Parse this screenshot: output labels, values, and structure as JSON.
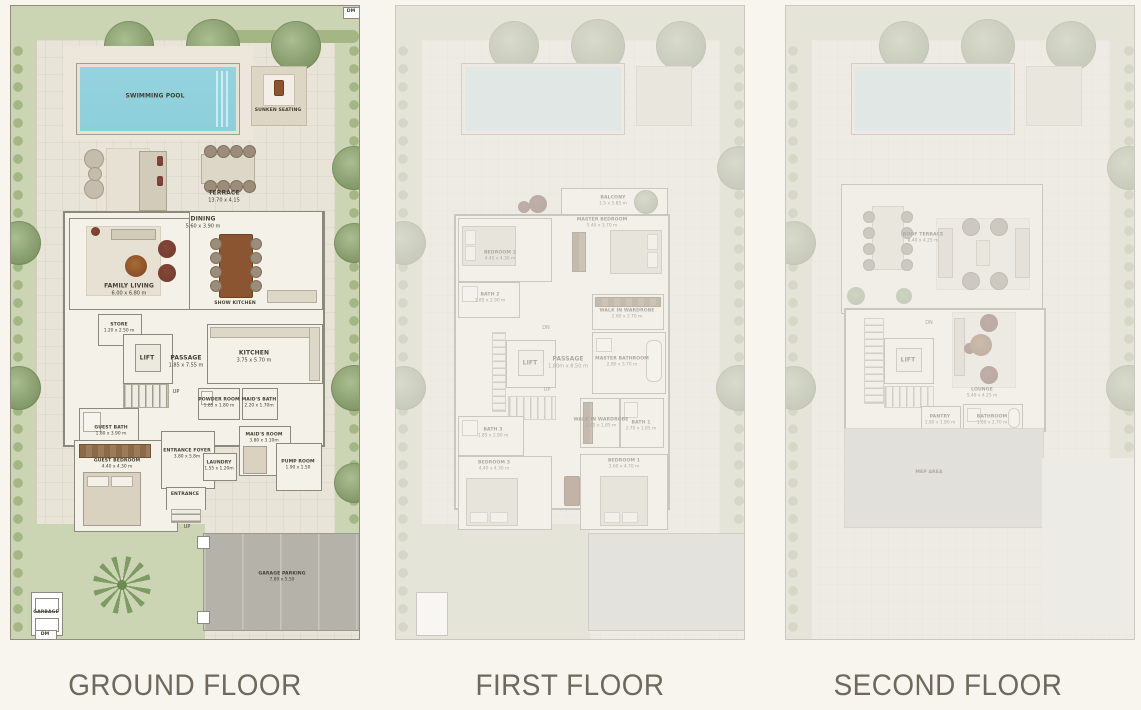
{
  "titles": {
    "ground": "GROUND FLOOR",
    "first": "FIRST FLOOR",
    "second": "SECOND FLOOR"
  },
  "palette": {
    "bg": "#f8f5ee",
    "paving": "#e9e4d8",
    "garden": "#cbd5b4",
    "hedge": "#a3b683",
    "tree": "#8ba171",
    "pool": "#8ccfdb",
    "wall": "#8b887e",
    "floor": "#f4f1e8",
    "wood": "#8a5530",
    "maroon": "#6f3a2d",
    "garage": "#b5b2aa",
    "label": "#454035",
    "title": "#6e685d"
  },
  "ground": {
    "pool": {
      "name": "SWIMMING POOL"
    },
    "sunken": {
      "name": "SUNKEN SEATING"
    },
    "terrace": {
      "name": "TERRACE",
      "dims": "13.70 x 4.15"
    },
    "dining": {
      "name": "DINING",
      "dims": "5.60 x 3.90 m"
    },
    "family_living": {
      "name": "FAMILY LIVING",
      "dims": "6.00 x 6.80 m"
    },
    "show_kitchen": {
      "name": "SHOW KITCHEN"
    },
    "store": {
      "name": "STORE",
      "dims": "1.20 x 2.50 m"
    },
    "lift": "LIFT",
    "passage": {
      "name": "PASSAGE",
      "dims": "1.85 x 7.55 m"
    },
    "kitchen": {
      "name": "KITCHEN",
      "dims": "3.75 x 5.70 m"
    },
    "up_stairs": "UP",
    "powder": {
      "name": "POWDER ROOM",
      "dims": "1.85 x 1.80 m"
    },
    "maids_bath": {
      "name": "MAID'S BATH",
      "dims": "2.20 x 1.70m"
    },
    "guest_bath": {
      "name": "GUEST BATH",
      "dims": "1.80 x 3.90 m"
    },
    "maids_room": {
      "name": "MAID'S ROOM",
      "dims": "3.80 x 3.10m"
    },
    "guest_bedroom": {
      "name": "GUEST BEDROOM",
      "dims": "4.40 x 4.30 m"
    },
    "entrance_foyer": {
      "name": "ENTRANCE FOYER",
      "dims": "3.80 x 5.8m"
    },
    "laundry": {
      "name": "LAUNDRY",
      "dims": "1.55 x 1.20m"
    },
    "pump_room": {
      "name": "PUMP ROOM",
      "dims": "1.90 x 1.50"
    },
    "entrance": "ENTRANCE",
    "up_entrance": "UP",
    "garage": {
      "name": "GARAGE PARKING",
      "dims": "7.80 x 5.50"
    },
    "garbage": "GARBAGE",
    "dm_top": "DM",
    "dm_bottom": "DM"
  },
  "first": {
    "balcony": {
      "name": "BALCONY",
      "dims": "1.5 x 5.85 m"
    },
    "master_bedroom": {
      "name": "MASTER BEDROOM",
      "dims": "5.40 x 3.70 m"
    },
    "bedroom2": {
      "name": "BEDROOM 2",
      "dims": "4.40 x 4.30 m"
    },
    "bath2": {
      "name": "BATH 2",
      "dims": "1.85 x 2.90 m"
    },
    "wiw1": {
      "name": "WALK IN WARDROBE",
      "dims": "2.60 x 3.70 m"
    },
    "dn": "DN",
    "lift": "LIFT",
    "passage": {
      "name": "PASSAGE",
      "dims": "1.80m x 8.50 m"
    },
    "master_bathroom": {
      "name": "MASTER BATHROOM",
      "dims": "2.80 x 3.70 m"
    },
    "up": "UP",
    "bath3": {
      "name": "BATH 3",
      "dims": "1.85 x 2.90 m"
    },
    "wiw2": {
      "name": "WALK IN WARDROBE",
      "dims": "3.05 x 1.85 m"
    },
    "bath1": {
      "name": "BATH 1",
      "dims": "2.70 x 1.85 m"
    },
    "bedroom3": {
      "name": "BEDROOM 3",
      "dims": "4.40 x 4.30 m"
    },
    "bedroom1": {
      "name": "BEDROOM 1",
      "dims": "3.60 x 4.70 m"
    }
  },
  "second": {
    "roof_terrace": {
      "name": "ROOF TERRACE",
      "dims": "8.40 x 4.25 m"
    },
    "dn": "DN",
    "lift": "LIFT",
    "lounge": {
      "name": "LOUNGE",
      "dims": "5.40 x 4.25 m"
    },
    "pantry": {
      "name": "PANTRY",
      "dims": "1.80 x 1.80 m"
    },
    "bathroom": {
      "name": "BATHROOM",
      "dims": "1.80 x 2.70 m"
    },
    "mep": "MEP AREA"
  }
}
